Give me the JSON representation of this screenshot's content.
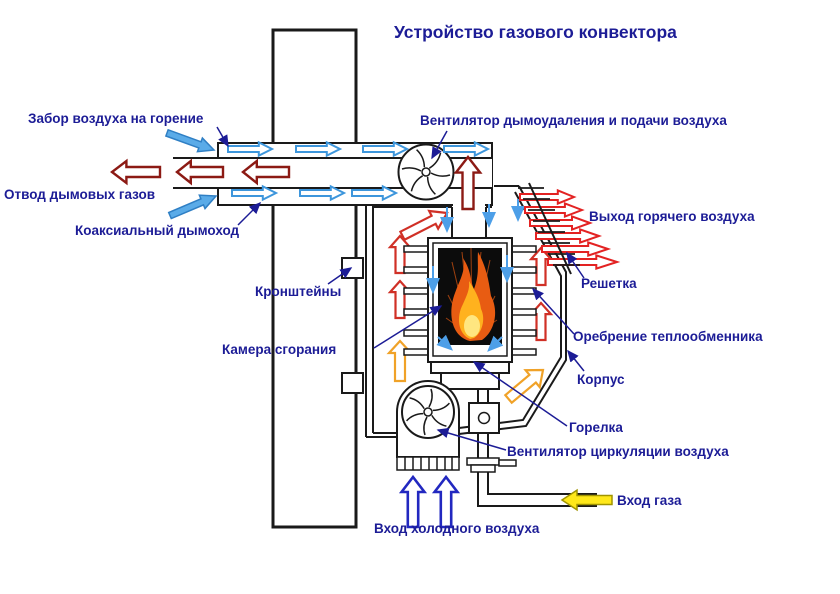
{
  "title": "Устройство газового конвектора",
  "labels": {
    "air_intake": "Забор воздуха на горение",
    "flue_gas_outlet": "Отвод дымовых газов",
    "coaxial_chimney": "Коаксиальный дымоход",
    "smoke_exhaust_fan": "Вентилятор дымоудаления и подачи воздуха",
    "hot_air_outlet": "Выход горячего воздуха",
    "grille": "Решетка",
    "heat_exchanger_fins": "Оребрение теплообменника",
    "casing": "Корпус",
    "burner": "Горелка",
    "circulation_fan": "Вентилятор циркуляции воздуха",
    "gas_inlet": "Вход газа",
    "cold_air_inlet": "Вход холодного воздуха",
    "brackets": "Кронштейны",
    "combustion_chamber": "Камера сгорания"
  },
  "colors": {
    "label_navy": "#1c1c96",
    "outline_black": "#1a1a1a",
    "flue_dark_red": "#8c1a14",
    "hot_air_red": "#e32222",
    "channel_red": "#d03026",
    "warm_orange": "#f0a228",
    "duct_air_blue": "#3d96dc",
    "intake_fill_blue": "#5aabe8",
    "cold_air_blue": "#2228c0",
    "gas_yellow": "#ffe81a",
    "flame_orange": "#e85c12",
    "flame_yellow": "#ffb21e"
  }
}
